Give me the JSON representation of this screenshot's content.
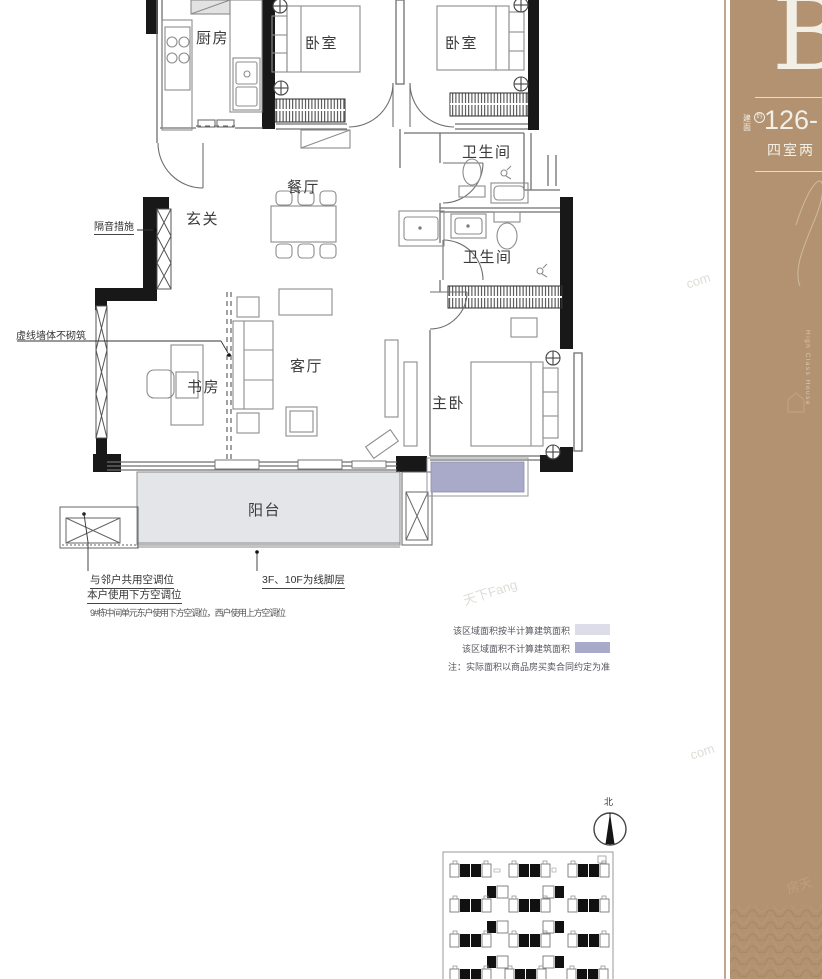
{
  "floor_plan": {
    "rooms": {
      "kitchen": "厨房",
      "bedroom1": "卧室",
      "bedroom2": "卧室",
      "bath1": "卫生间",
      "dining": "餐厅",
      "entry": "玄关",
      "bath2": "卫生间",
      "study": "书房",
      "living": "客厅",
      "master": "主卧",
      "balcony": "阳台"
    },
    "annotations": {
      "soundproof": "隔音措施",
      "dashed_wall": "虚线墙体不砌筑",
      "ac_shared": "与邻户共用空调位",
      "ac_lower": "本户使用下方空调位",
      "molding": "3F、10F为线脚层",
      "ac_note": "9#栋中间单元东户使用下方空调位，西户使用上方空调位"
    }
  },
  "legend": {
    "half_label": "该区域面积按半计算建筑面积",
    "excluded_label": "该区域面积不计算建筑面积",
    "note": "注：实际面积以商品房买卖合同约定为准",
    "half_color": "#dcdde9",
    "excluded_color": "#a9aac9"
  },
  "compass": {
    "north_label": "北"
  },
  "sidebar": {
    "plan_letter": "B",
    "area_label": "建面",
    "area_approx": "约",
    "area_value": "126-",
    "layout_text": "四室两",
    "tagline": "High Class House",
    "accent_color": "#b29270",
    "text_color": "#f2efe7"
  },
  "watermarks": {
    "w1": "com",
    "w2": "天下Fang",
    "w3": "com",
    "w4": "房天"
  }
}
